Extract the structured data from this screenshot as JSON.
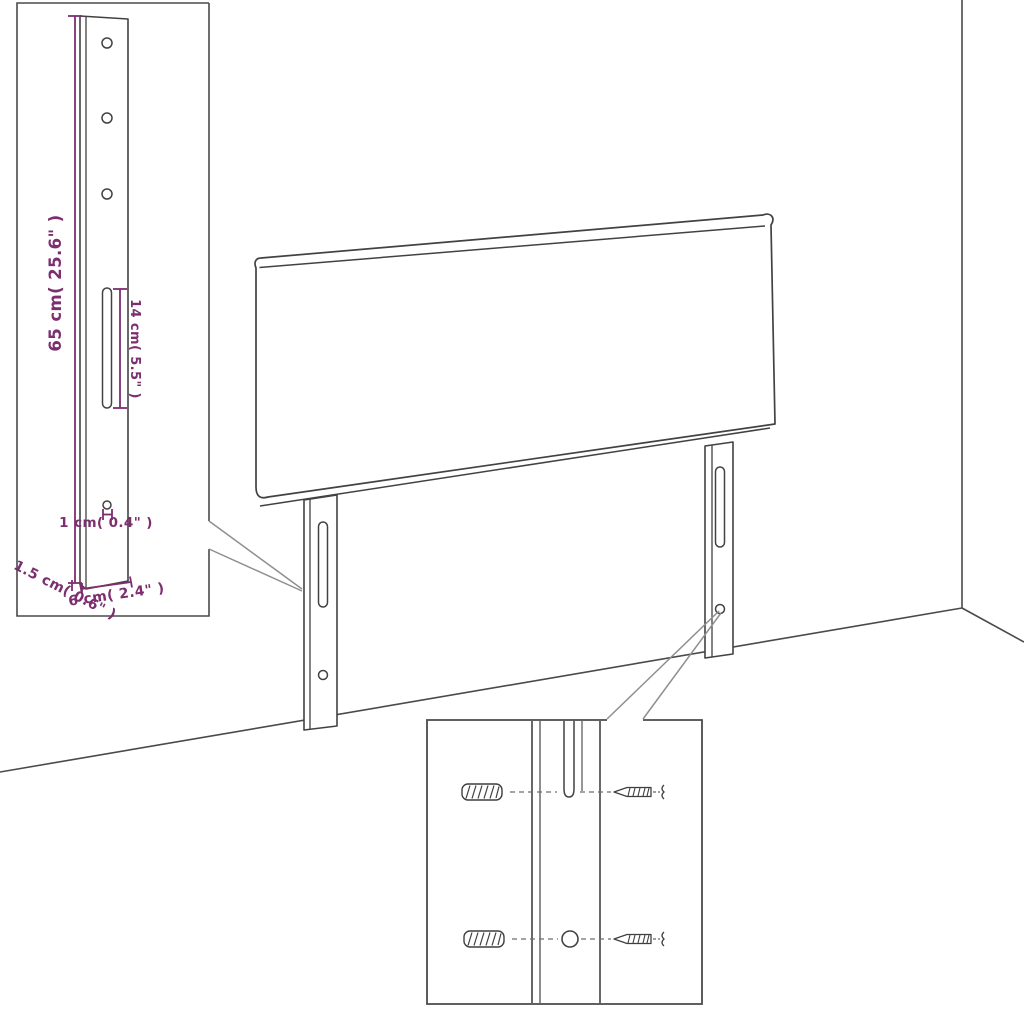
{
  "diagram": {
    "type": "furniture-assembly-dimension-diagram",
    "product": "upholstered headboard with two mounting legs",
    "colors": {
      "line_art": "#424242",
      "inset_frame": "#4a4a4a",
      "leader_line": "#8f8f8f",
      "dimension": "#7c2e6f",
      "background": "#ffffff"
    },
    "leg_inset": {
      "dim_leg_height": "65 cm( 25.6\" )",
      "dim_slot_length": "14 cm( 5.5\" )",
      "dim_hole_diameter": "1 cm( 0.4\" )",
      "dim_leg_depth": "1.5 cm( 0.6\" )",
      "dim_leg_width": "6 cm( 2.4\" )"
    },
    "mounting_inset": {
      "parts": [
        "wall plug",
        "screw",
        "keyhole slot",
        "round hole"
      ]
    }
  }
}
